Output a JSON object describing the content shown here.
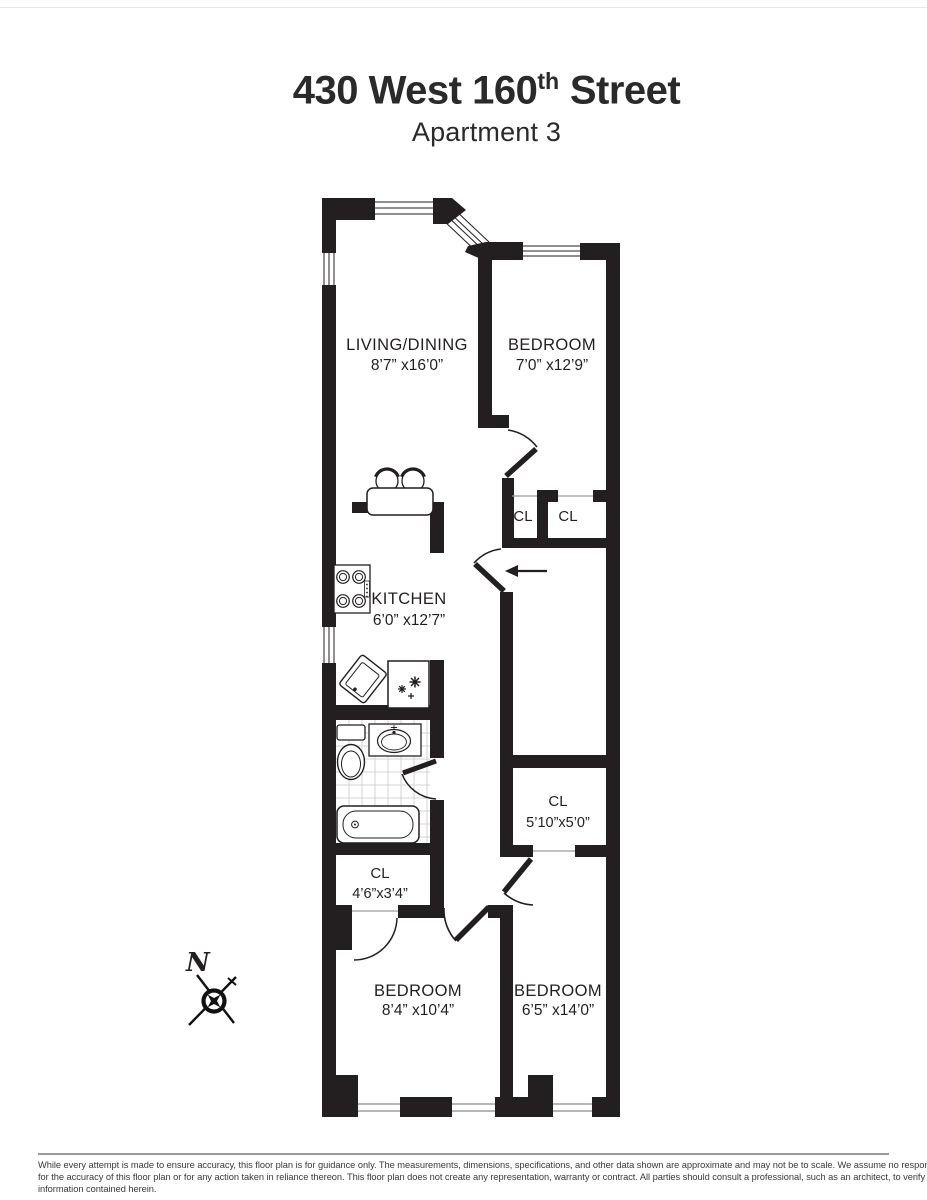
{
  "title": {
    "prefix": "430 West 160",
    "superscript": "th",
    "suffix": " Street",
    "subtitle": "Apartment 3"
  },
  "rooms": {
    "living_dining": {
      "name": "LIVING/DINING",
      "dims": "8’7” x16’0”"
    },
    "bedroom_top": {
      "name": "BEDROOM",
      "dims": "7’0” x12’9”"
    },
    "kitchen": {
      "name": "KITCHEN",
      "dims": "6’0” x12’7”"
    },
    "bedroom_bottom_left": {
      "name": "BEDROOM",
      "dims": "8’4” x10’4”"
    },
    "bedroom_bottom_right": {
      "name": "BEDROOM",
      "dims": "6’5” x14’0”"
    },
    "closet_hall_left": {
      "name": "CL"
    },
    "closet_hall_right": {
      "name": "CL"
    },
    "closet_large": {
      "name": "CL",
      "dims": "5’10”x5’0”"
    },
    "closet_small": {
      "name": "CL",
      "dims": "4’6”x3’4”"
    }
  },
  "compass": {
    "north_label": "N"
  },
  "disclaimer": {
    "line1": "While every attempt is made to ensure accuracy, this floor plan is for guidance only. The measurements, dimensions, specifications, and other data shown are approximate and may not be to scale.  We assume no responsibility",
    "line2": "for the accuracy of this floor plan or for any action taken in reliance thereon. This floor plan does not create any representation, warranty or contract. All parties should consult a professional, such as an architect, to verify the",
    "line3": "information contained herein."
  },
  "colors": {
    "wall": "#231f20",
    "window_line": "#8a8a8a",
    "tile_line": "#c9c9c9"
  }
}
